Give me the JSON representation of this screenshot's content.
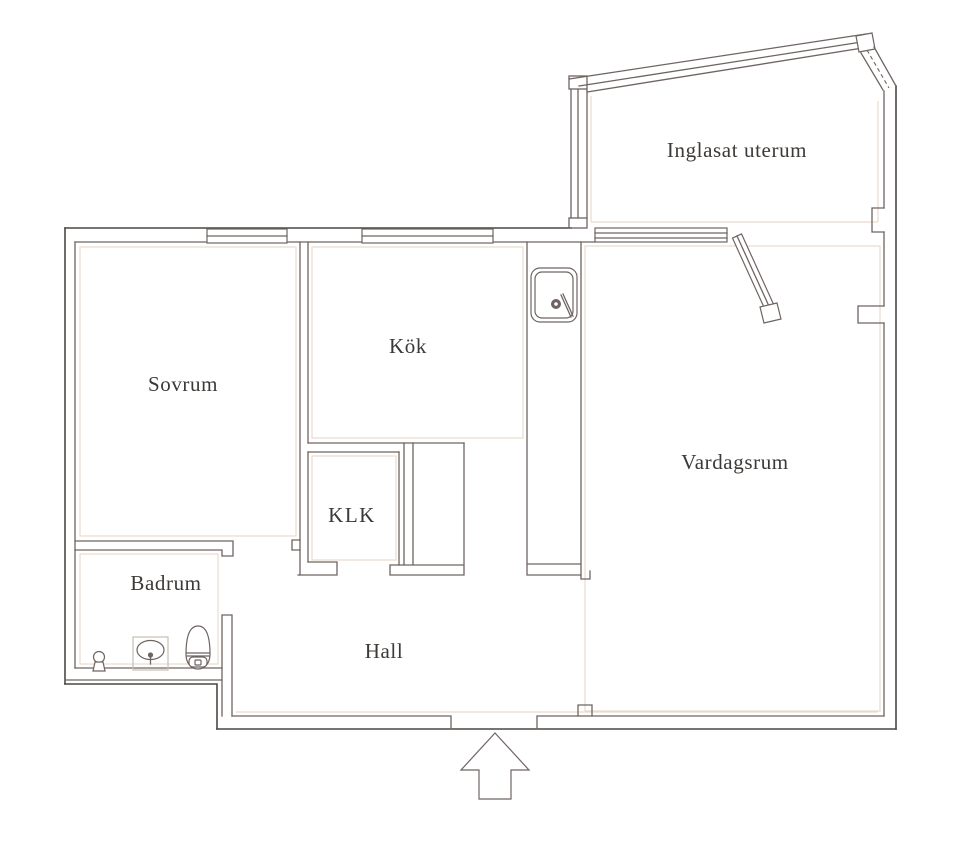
{
  "title": "Apartment floor plan",
  "rooms": {
    "inglasat_uterum": {
      "label": "Inglasat uterum"
    },
    "sovrum": {
      "label": "Sovrum"
    },
    "kok": {
      "label": "Kök"
    },
    "klk": {
      "label": "KLK"
    },
    "vardagsrum": {
      "label": "Vardagsrum"
    },
    "badrum": {
      "label": "Badrum"
    },
    "hall": {
      "label": "Hall"
    }
  },
  "icons": {
    "kitchen_sink": "kitchen-sink-icon",
    "bathroom_sink": "bathroom-sink-icon",
    "toilet": "toilet-icon",
    "shower_valve": "shower-valve-icon",
    "entrance_arrow": "entrance-arrow-icon"
  },
  "colors": {
    "wall": "#6e6461",
    "wall_dark": "#4c4744",
    "accent": "#eadacd",
    "text": "#3c3936",
    "bg": "#ffffff"
  }
}
